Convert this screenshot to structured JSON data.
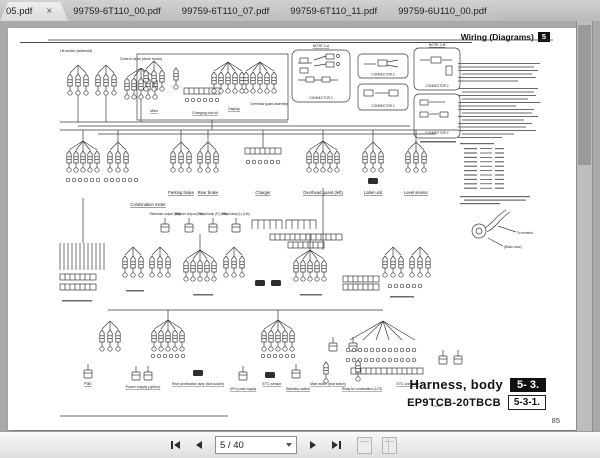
{
  "window": {
    "tabbar": {
      "active_tab": "05.pdf",
      "close_glyph": "×",
      "tabs": [
        "99759-6T110_00.pdf",
        "99759-6T110_07.pdf",
        "99759-6T110_11.pdf",
        "99759-6U110_00.pdf"
      ]
    }
  },
  "header": {
    "title": "Wiring (Diagrams)",
    "chapter_badge": "5"
  },
  "title_block": {
    "name": "Harness, body",
    "section": "5- 3.",
    "model": "EP9TCB-20TBCB",
    "ref": "5-3-1."
  },
  "page_number": "85",
  "toolbar": {
    "page_indicator": "5 / 40"
  },
  "colors": {
    "badge_bg": "#111111",
    "diagram_stroke": "#3a3a3a",
    "page_bg": "#ffffff"
  },
  "diagram": {
    "labels": {
      "l0": "Lift switch (solenoid)",
      "l1": "Control valve (drive motor)",
      "l2": "Main",
      "l3": "Charging box kit",
      "l4": "Display",
      "l5": "Overhead guard assembly",
      "l6": "Parking brake",
      "l7": "Rear brake",
      "l8": "Charger",
      "l9": "Overhead guard (left)",
      "l10": "Label unit",
      "l11": "Level sensor",
      "l12": "Combination meter",
      "l13": "Rearward output (NA)",
      "l14": "Washer output (NA)",
      "l15": "Head lamp (R) (NA)",
      "l16": "Head lamp (L) (NA)",
      "l17": "Fan",
      "l18": "Power supply (option)",
      "l19": "Rear combination lamp (bulb socket)",
      "l20": "GPS power supply",
      "l21": "ETC sensor",
      "l22": "Standby switch",
      "l23": "Main switch (seat switch)",
      "l24": "Relay for combination (LCS)",
      "l25": "ETC controller",
      "l26": "(Black color)",
      "l27": "To terminal"
    },
    "note_boxes": [
      {
        "title": "NOTE 2-A",
        "caption": "CONNECTOR 2"
      },
      {
        "caption": "CONNECTOR 2"
      },
      {
        "caption": "CONNECTOR 2"
      },
      {
        "title": "NOTE 2-B",
        "caption": "CONNECTOR 2"
      },
      {
        "caption": "CONNECTOR 2"
      }
    ]
  }
}
